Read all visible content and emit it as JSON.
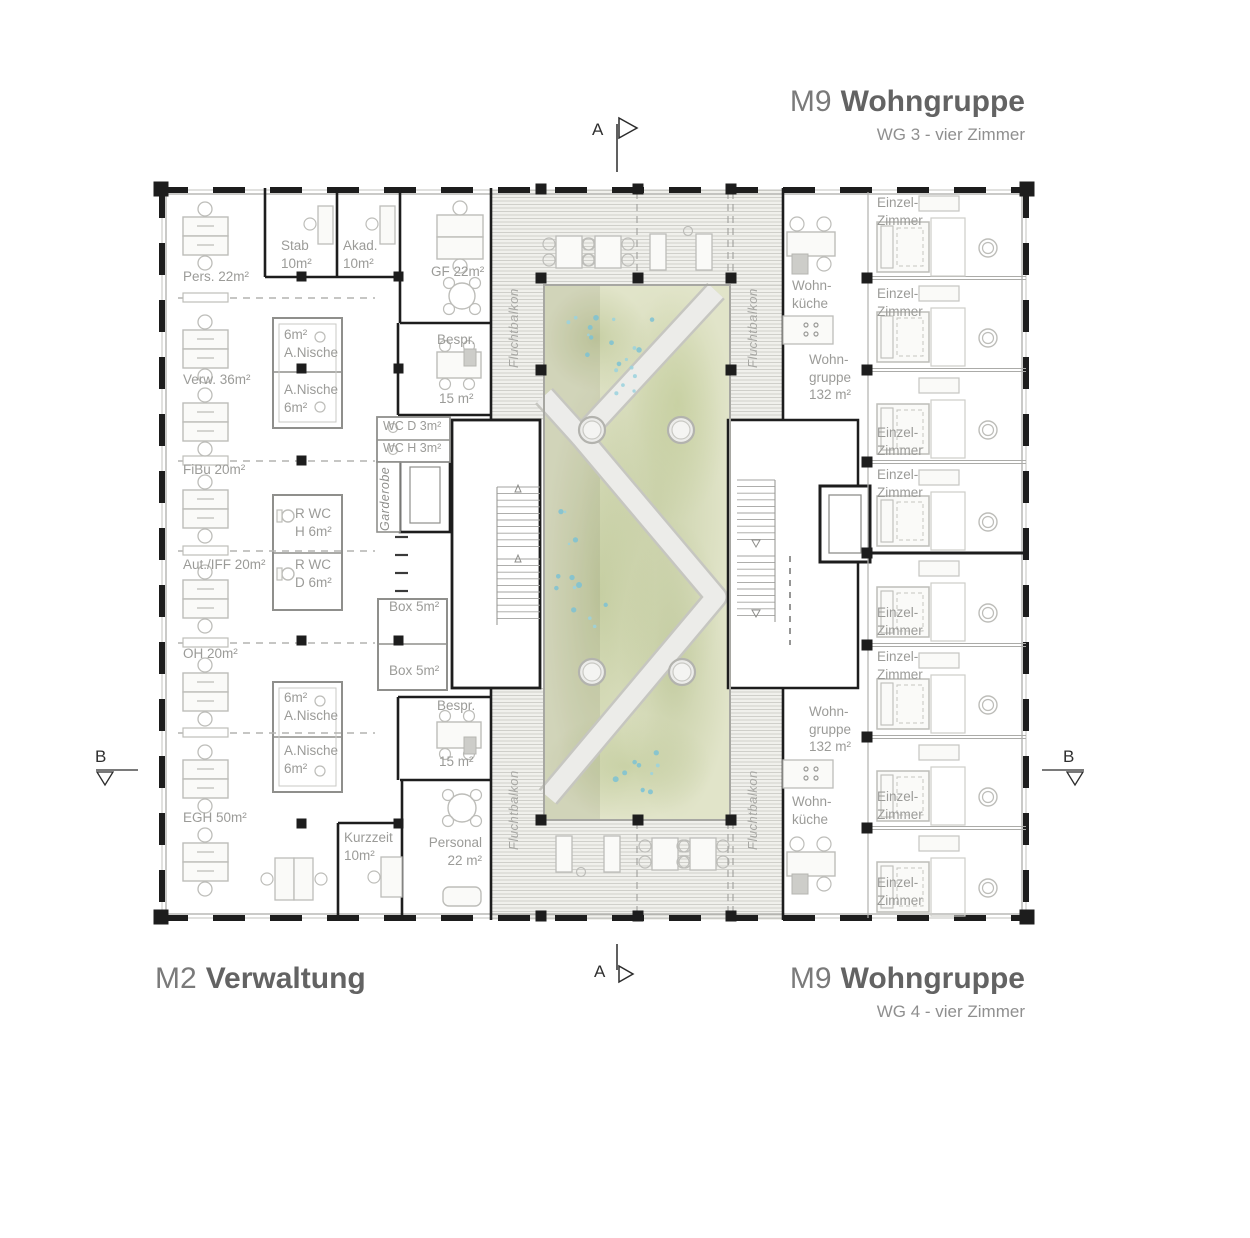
{
  "titles": {
    "top_right": {
      "code": "M9",
      "name": "Wohngruppe",
      "subtitle": "WG 3 - vier Zimmer"
    },
    "bottom_left": {
      "code": "M2",
      "name": "Verwaltung"
    },
    "bottom_right": {
      "code": "M9",
      "name": "Wohngruppe",
      "subtitle": "WG 4 - vier Zimmer"
    }
  },
  "section_markers": {
    "a_top": "A",
    "a_bottom": "A",
    "b_left": "B",
    "b_right": "B"
  },
  "labels": {
    "pers": "Pers. 22m²",
    "stab": "Stab\n10m²",
    "akad": "Akad.\n10m²",
    "gf": "GF 22m²",
    "verw": "Verw. 36m²",
    "nische_top_a": "6m²\nA.Nische",
    "nische_top_b": "A.Nische\n6m²",
    "bespr_top": "Bespr.",
    "bespr_top_area": "15 m²",
    "wc_d": "WC D 3m²",
    "wc_h": "WC H 3m²",
    "garderobe": "Garderobe",
    "fibu": "FiBu 20m²",
    "rwc_h": "R WC\nH 6m²",
    "aut_iff": "Aut./IFF 20m²",
    "rwc_d": "R WC\nD 6m²",
    "oh": "OH 20m²",
    "box_1": "Box 5m²",
    "box_2": "Box 5m²",
    "nische_bot_a": "6m²\nA.Nische",
    "nische_bot_b": "A.Nische\n6m²",
    "egh": "EGH 50m²",
    "kurzzeit": "Kurzzeit\n10m²",
    "personal": "Personal\n22 m²",
    "bespr_bot": "Bespr.",
    "bespr_bot_area": "15 m²",
    "wohnkueche_top": "Wohn-\nküche",
    "wohngruppe_top": "Wohn-\ngruppe\n132 m²",
    "wohngruppe_bot": "Wohn-\ngruppe\n132 m²",
    "wohnkueche_bot": "Wohn-\nküche",
    "einzelzimmer": "Einzel-\nZimmer",
    "fluchtbalkon": "Fluchtbalkon"
  },
  "colors": {
    "wall": "#1d1d1d",
    "label_text": "#9b9b98",
    "title_text": "#6e6e6e",
    "courtyard_green": "#e1e4c9",
    "path_gray": "#eaeae6",
    "water_dots": "#7cc2d4",
    "deck_line": "#cfcfca"
  }
}
